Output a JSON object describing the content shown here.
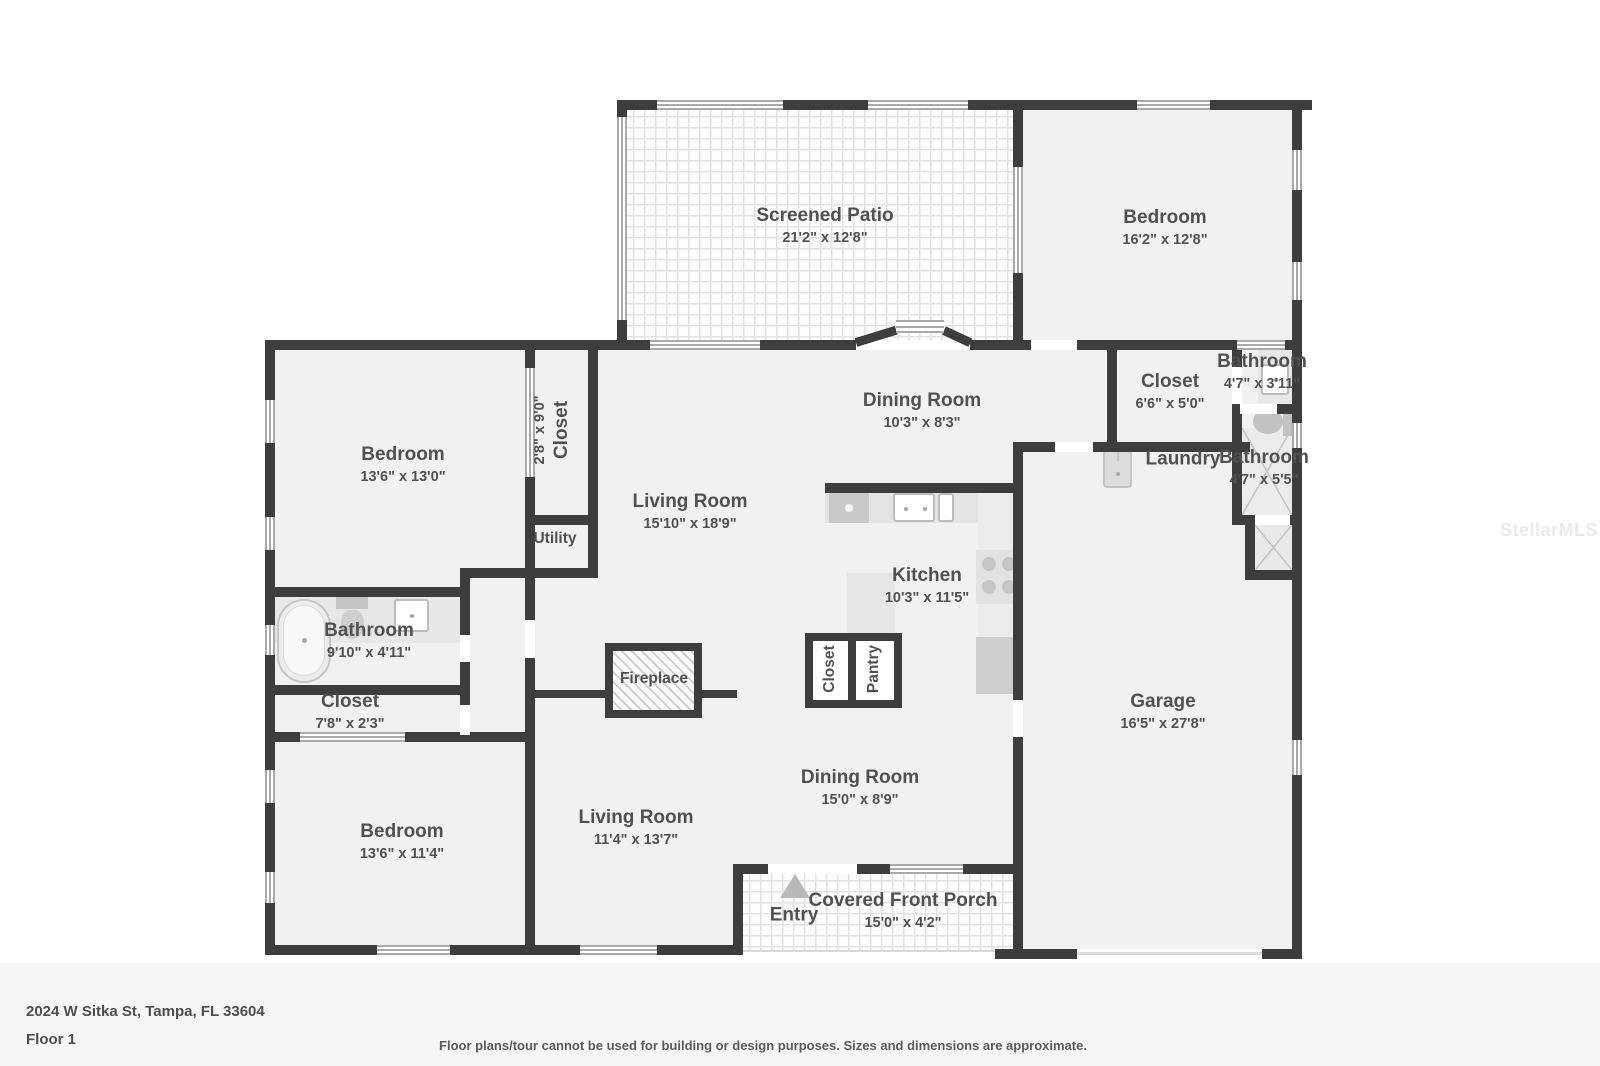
{
  "address": "2024 W Sitka St, Tampa, FL 33604",
  "floor_label": "Floor 1",
  "disclaimer": "Floor plans/tour cannot be used for building or design purposes. Sizes and dimensions are approximate.",
  "watermark": "StellarMLS",
  "colors": {
    "wall": "#3d3d3d",
    "room_fill": "#f1f1f1",
    "label_text": "#505050",
    "fixture_gray": "#cecece"
  },
  "rooms": {
    "screened_patio": {
      "name": "Screened Patio",
      "dims": "21'2\" x 12'8\""
    },
    "bedroom_top_right": {
      "name": "Bedroom",
      "dims": "16'2\" x 12'8\""
    },
    "bathroom_1": {
      "name": "Bathroom",
      "dims": "4'7\" x 3'11\""
    },
    "closet_hall": {
      "name": "Closet",
      "dims": "6'6\" x 5'0\""
    },
    "laundry": {
      "name": "Laundry"
    },
    "bathroom_2": {
      "name": "Bathroom",
      "dims": "4'7\" x 5'5\""
    },
    "dining_room_1": {
      "name": "Dining Room",
      "dims": "10'3\" x 8'3\""
    },
    "living_room_1": {
      "name": "Living Room",
      "dims": "15'10\" x 18'9\""
    },
    "closet_vertical": {
      "name": "Closet",
      "dims": "2'8\" x 9'0\""
    },
    "utility": {
      "name": "Utility"
    },
    "bedroom_left": {
      "name": "Bedroom",
      "dims": "13'6\" x 13'0\""
    },
    "kitchen": {
      "name": "Kitchen",
      "dims": "10'3\" x 11'5\""
    },
    "bathroom_3": {
      "name": "Bathroom",
      "dims": "9'10\" x 4'11\""
    },
    "closet_2": {
      "name": "Closet",
      "dims": "7'8\" x 2'3\""
    },
    "fireplace": {
      "name": "Fireplace"
    },
    "closet_kitchen": {
      "name": "Closet"
    },
    "pantry": {
      "name": "Pantry"
    },
    "garage": {
      "name": "Garage",
      "dims": "16'5\" x 27'8\""
    },
    "bedroom_bottom_left": {
      "name": "Bedroom",
      "dims": "13'6\" x 11'4\""
    },
    "living_room_2": {
      "name": "Living Room",
      "dims": "11'4\" x 13'7\""
    },
    "dining_room_2": {
      "name": "Dining Room",
      "dims": "15'0\" x 8'9\""
    },
    "entry": {
      "name": "Entry"
    },
    "covered_front_porch": {
      "name": "Covered Front Porch",
      "dims": "15'0\" x 4'2\""
    }
  }
}
